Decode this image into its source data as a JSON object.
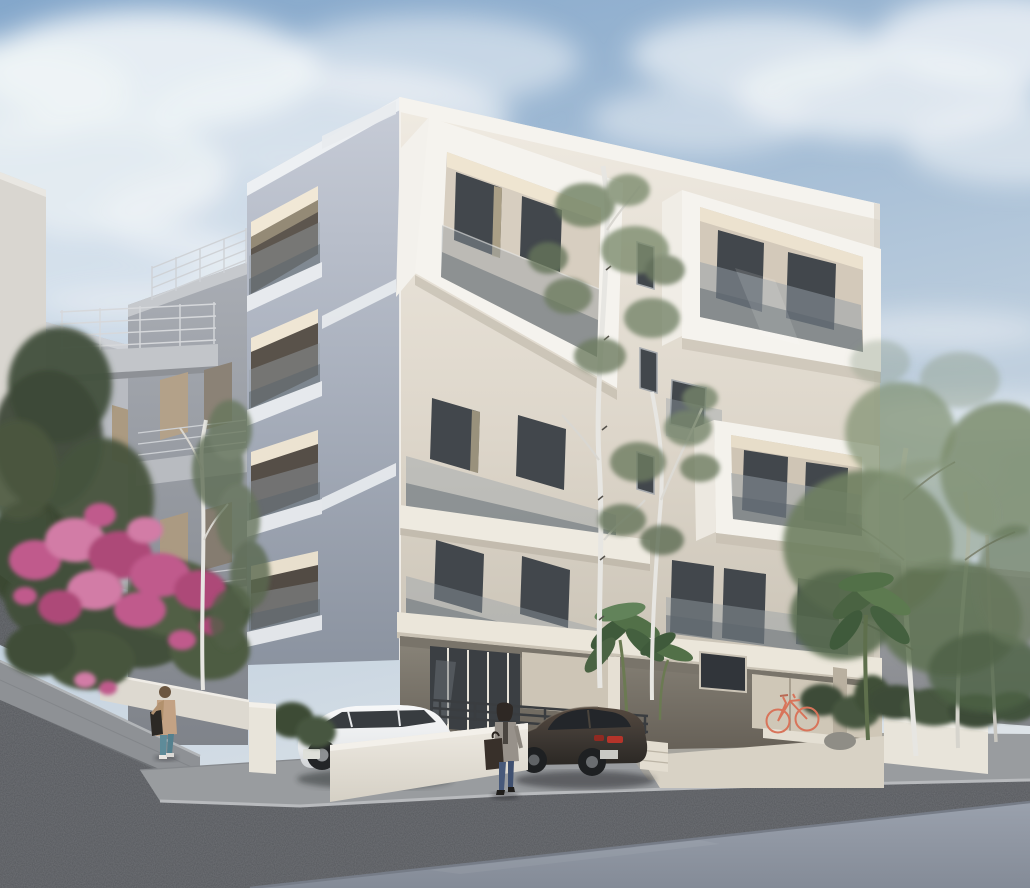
{
  "scene": {
    "type": "architectural exterior 3D rendering",
    "description": "Photorealistic render of a modern five-level white apartment building with protruding box balconies and frameless glass balustrades, seen from the street corner on a partly cloudy day. A cobbled street slopes up to the left past a pink flowering shrub, a white hatchback and a dark sedan are parked in front, two pedestrians walk along the pavement, a coral bicycle leans under the open ground-floor pilotis, and birch trees frame the building.",
    "time_of_day": "daytime",
    "weather": "partly cloudy"
  },
  "palette": {
    "sky_top": "#84a7cb",
    "sky_mid": "#b9cbdc",
    "sky_horizon": "#dde3e8",
    "cloud": "#f0f4f7",
    "facade_front": "#ece6db",
    "facade_side": "#b0b7c4",
    "trim_white": "#f5f3ee",
    "fascia": "#ebe6da",
    "glass_tint": "#96a0a7",
    "glass_dark": "#5a646c",
    "window_dark": "#42474c",
    "neighbor_gray": "#a7abb2",
    "neighbor_light": "#d9d6d0",
    "rear_wall": "#9fa1a5",
    "pilotis_dark": "#6e685e",
    "wall_white": "#e8e4da",
    "sidewalk": "#999c9f",
    "cobble": "#54575b",
    "asphalt": "#979ea9",
    "foliage": "#6e7f61",
    "foliage_dark": "#42503b",
    "foliage_light": "#87977b",
    "flower_pink": "#c05a8c",
    "flower_pink_light": "#d27ba6",
    "flower_pink_dark": "#ad4a78",
    "birch": "#e7e6e2",
    "car_white": "#f2f3f4",
    "car_dark": "#3f3934",
    "taillight_red": "#b5342a",
    "bicycle_coral": "#d8745a",
    "door_dark": "#33373b",
    "railing_dark": "#3a3d40",
    "jacket_beige": "#c3a284",
    "denim_teal": "#5e8b99",
    "denim_blue": "#47597a"
  },
  "objects": {
    "main_building": {
      "levels_visible": 5,
      "balcony_style": "white box-frame balconies with frameless glass balustrades",
      "side_facade": "shaded grey face with recessed lit balconies and horizontal white stripe accents",
      "ground_floor": "open pilotis with lobby glazing, dark entrance railing and parking bay"
    },
    "neighbor_buildings": "grey concrete apartment blocks with thin metal balcony railings and tan roller shutters",
    "vehicles": [
      {
        "name": "white hatchback",
        "position": "parked on street, partly behind garden wall"
      },
      {
        "name": "dark brown sedan",
        "position": "parked by driveway, rear with red taillights toward street"
      }
    ],
    "bicycle": {
      "color": "coral",
      "position": "leaning on wall under pilotis"
    },
    "people": [
      {
        "name": "pedestrian on ramp",
        "look": "beige hooded jacket, teal jeans, black shoulder bag, walking uphill"
      },
      {
        "name": "woman on pavement",
        "look": "dark bob, grey cardigan, blue jeans, large dark tote bag"
      }
    ],
    "vegetation": [
      "pink flowering shrub on the left slope",
      "dark green tree far left",
      "white-trunked birch trees in front of the facade",
      "banana plants at the entrance",
      "leafy trees and shrubs on the right"
    ],
    "street": {
      "foreground": "dark cobblestone roadway",
      "bottom_right": "smooth light asphalt",
      "left": "paved pedestrian ramp climbing beside retaining walls"
    }
  }
}
